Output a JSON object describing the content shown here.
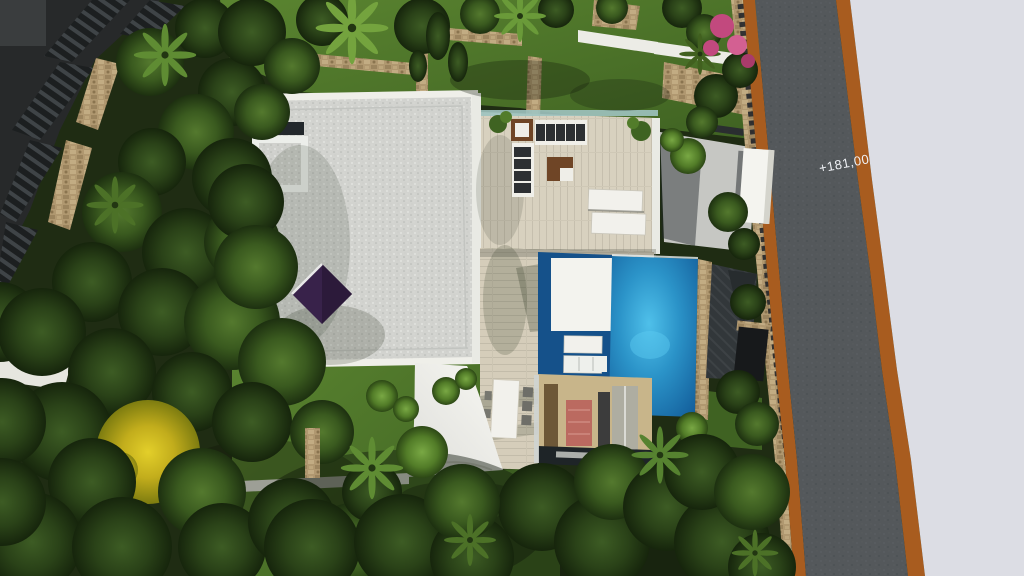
{
  "scene": {
    "elevation_label": "+181,00",
    "colors": {
      "road_asphalt": "#54585b",
      "road_curb": "#a85c1f",
      "offsite_ground": "#dcdde4",
      "roof_gravel": "#d2d3cf",
      "roof_parapet": "#efefe9",
      "pool_light": "#4fc0ea",
      "pool_deep": "#135e9b",
      "wet_deck": "#15518a",
      "deck_wood": "#d8d1bf",
      "lawn_light": "#5a8430",
      "lawn_dark": "#3f6222",
      "tree_canopy_dark": "#16250c",
      "tree_canopy_yellow": "#c2ad1c",
      "shade_sail": "#f1f1ea",
      "patio_umbrella": "#38224a",
      "stone_wall": "#b09870",
      "courtyard_floor": "#c8b58a",
      "area_rug": "#bb6a60",
      "neighbor_structure": "#27292a",
      "flower_pink": "#c2497e",
      "glass_balustrade": "#9ec3c0"
    }
  }
}
